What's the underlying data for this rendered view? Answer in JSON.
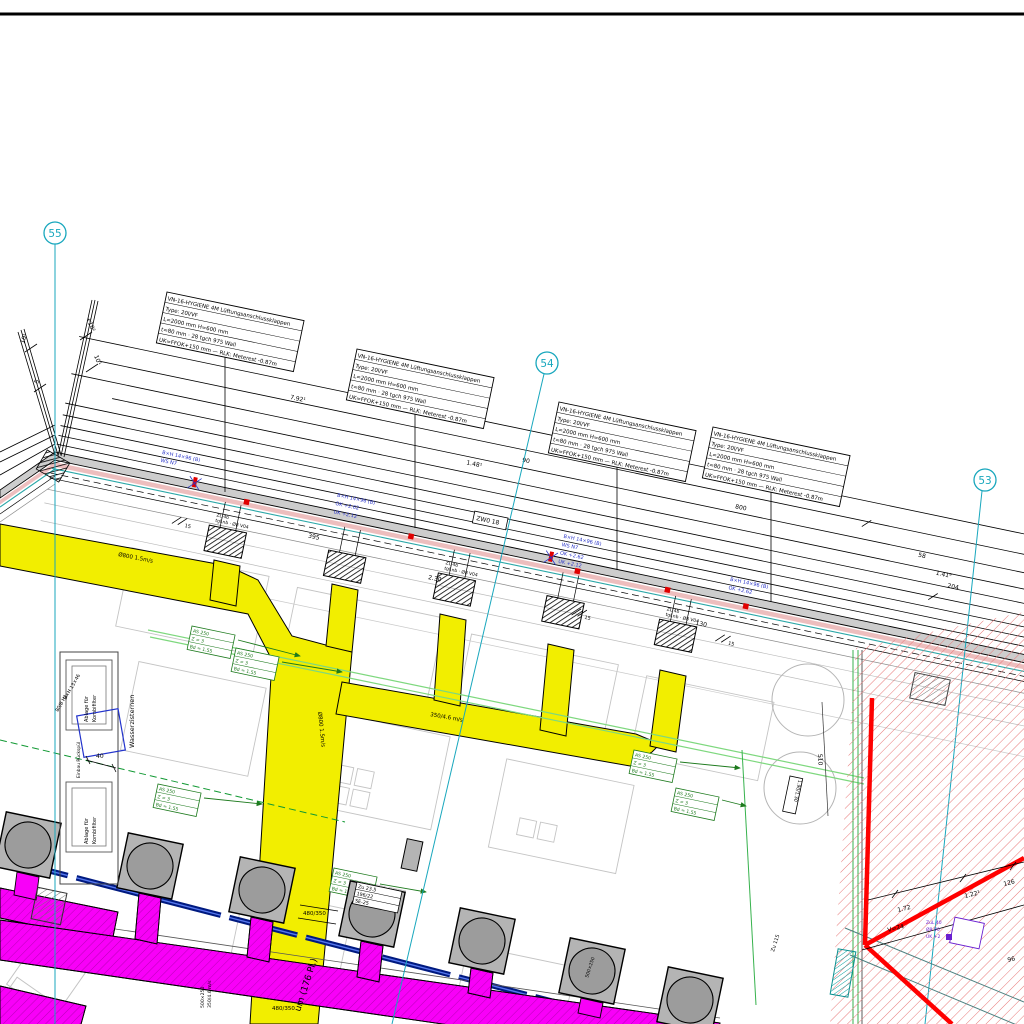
{
  "colors": {
    "grid_cyan": "#18a7bd",
    "supply_duct_yellow": "#f2ee00",
    "exhaust_duct_magenta": "#f800f8",
    "pipe_navy": "#001a80",
    "zone_red": "#ff0000",
    "callout_green": "#1d7a1d",
    "label_blue": "#2a35c8"
  },
  "grid_bubbles": [
    {
      "label": "55"
    },
    {
      "label": "54"
    },
    {
      "label": "53"
    }
  ],
  "callout_box": {
    "row1": "VN-16-HYGIENE 4M Lüftungsanschlussklappen",
    "row2": "Type: 20l/VF",
    "row3": "L=2000 mm  H=600 mm",
    "row4": "t=80 mm · 28 tgch 975 Wall",
    "row5": "UK=FFOK+150 mm — RLK: Meterest -0.87m"
  },
  "blue_callout": {
    "l1": "B×H 14×96 (B)",
    "l2": "WS N7",
    "l3": "OK +2.62",
    "l4": "UK +2.12"
  },
  "green_callout": {
    "l1": "AS 250",
    "l2": "Z = 3",
    "l3": "Bd = 1.55"
  },
  "purple_callout": {
    "l1": "ZuL 40",
    "l2": "Ø8 V0",
    "l3": "UK +2"
  },
  "fan_tag": {
    "l1": "Zu 23.5",
    "l2": "196/22",
    "l3": "SE-25"
  },
  "grille_tag": {
    "l1": "ZL 4b",
    "l2": "tgl.nb · Ø8 V04"
  },
  "dims": {
    "a": "7.92¹",
    "b": "1.48¹",
    "c": "90",
    "d": "800",
    "e": "58",
    "f": "1.41⁹",
    "g": "204",
    "h": "395",
    "i": "2.30",
    "j": "130",
    "k": "15",
    "l": "510",
    "m": "40",
    "n": "1.72",
    "o": "1.22¹",
    "p": "96",
    "q": "V=24",
    "r": "10¹",
    "s": "5",
    "t": "+10²",
    "u": "10¹",
    "v": "480/350",
    "w": "126"
  },
  "labels": {
    "zwo": "ZW0 18",
    "zu115": "Zu 115",
    "bike_room": "um (176 Pl.)",
    "wasser": "Wasserzisternen",
    "ablage": "Ablage für",
    "kombi": "Kombifilter",
    "einbau": "Einbau Rückspül",
    "tank_size": "B×H 13×46",
    "tank_type": "80/8 H1",
    "duct_d800": "Ø800 1.5m/s",
    "duct_500": "500×250",
    "duct_350": "350/4.6 m/s",
    "size_190": "1.90/1.30"
  }
}
